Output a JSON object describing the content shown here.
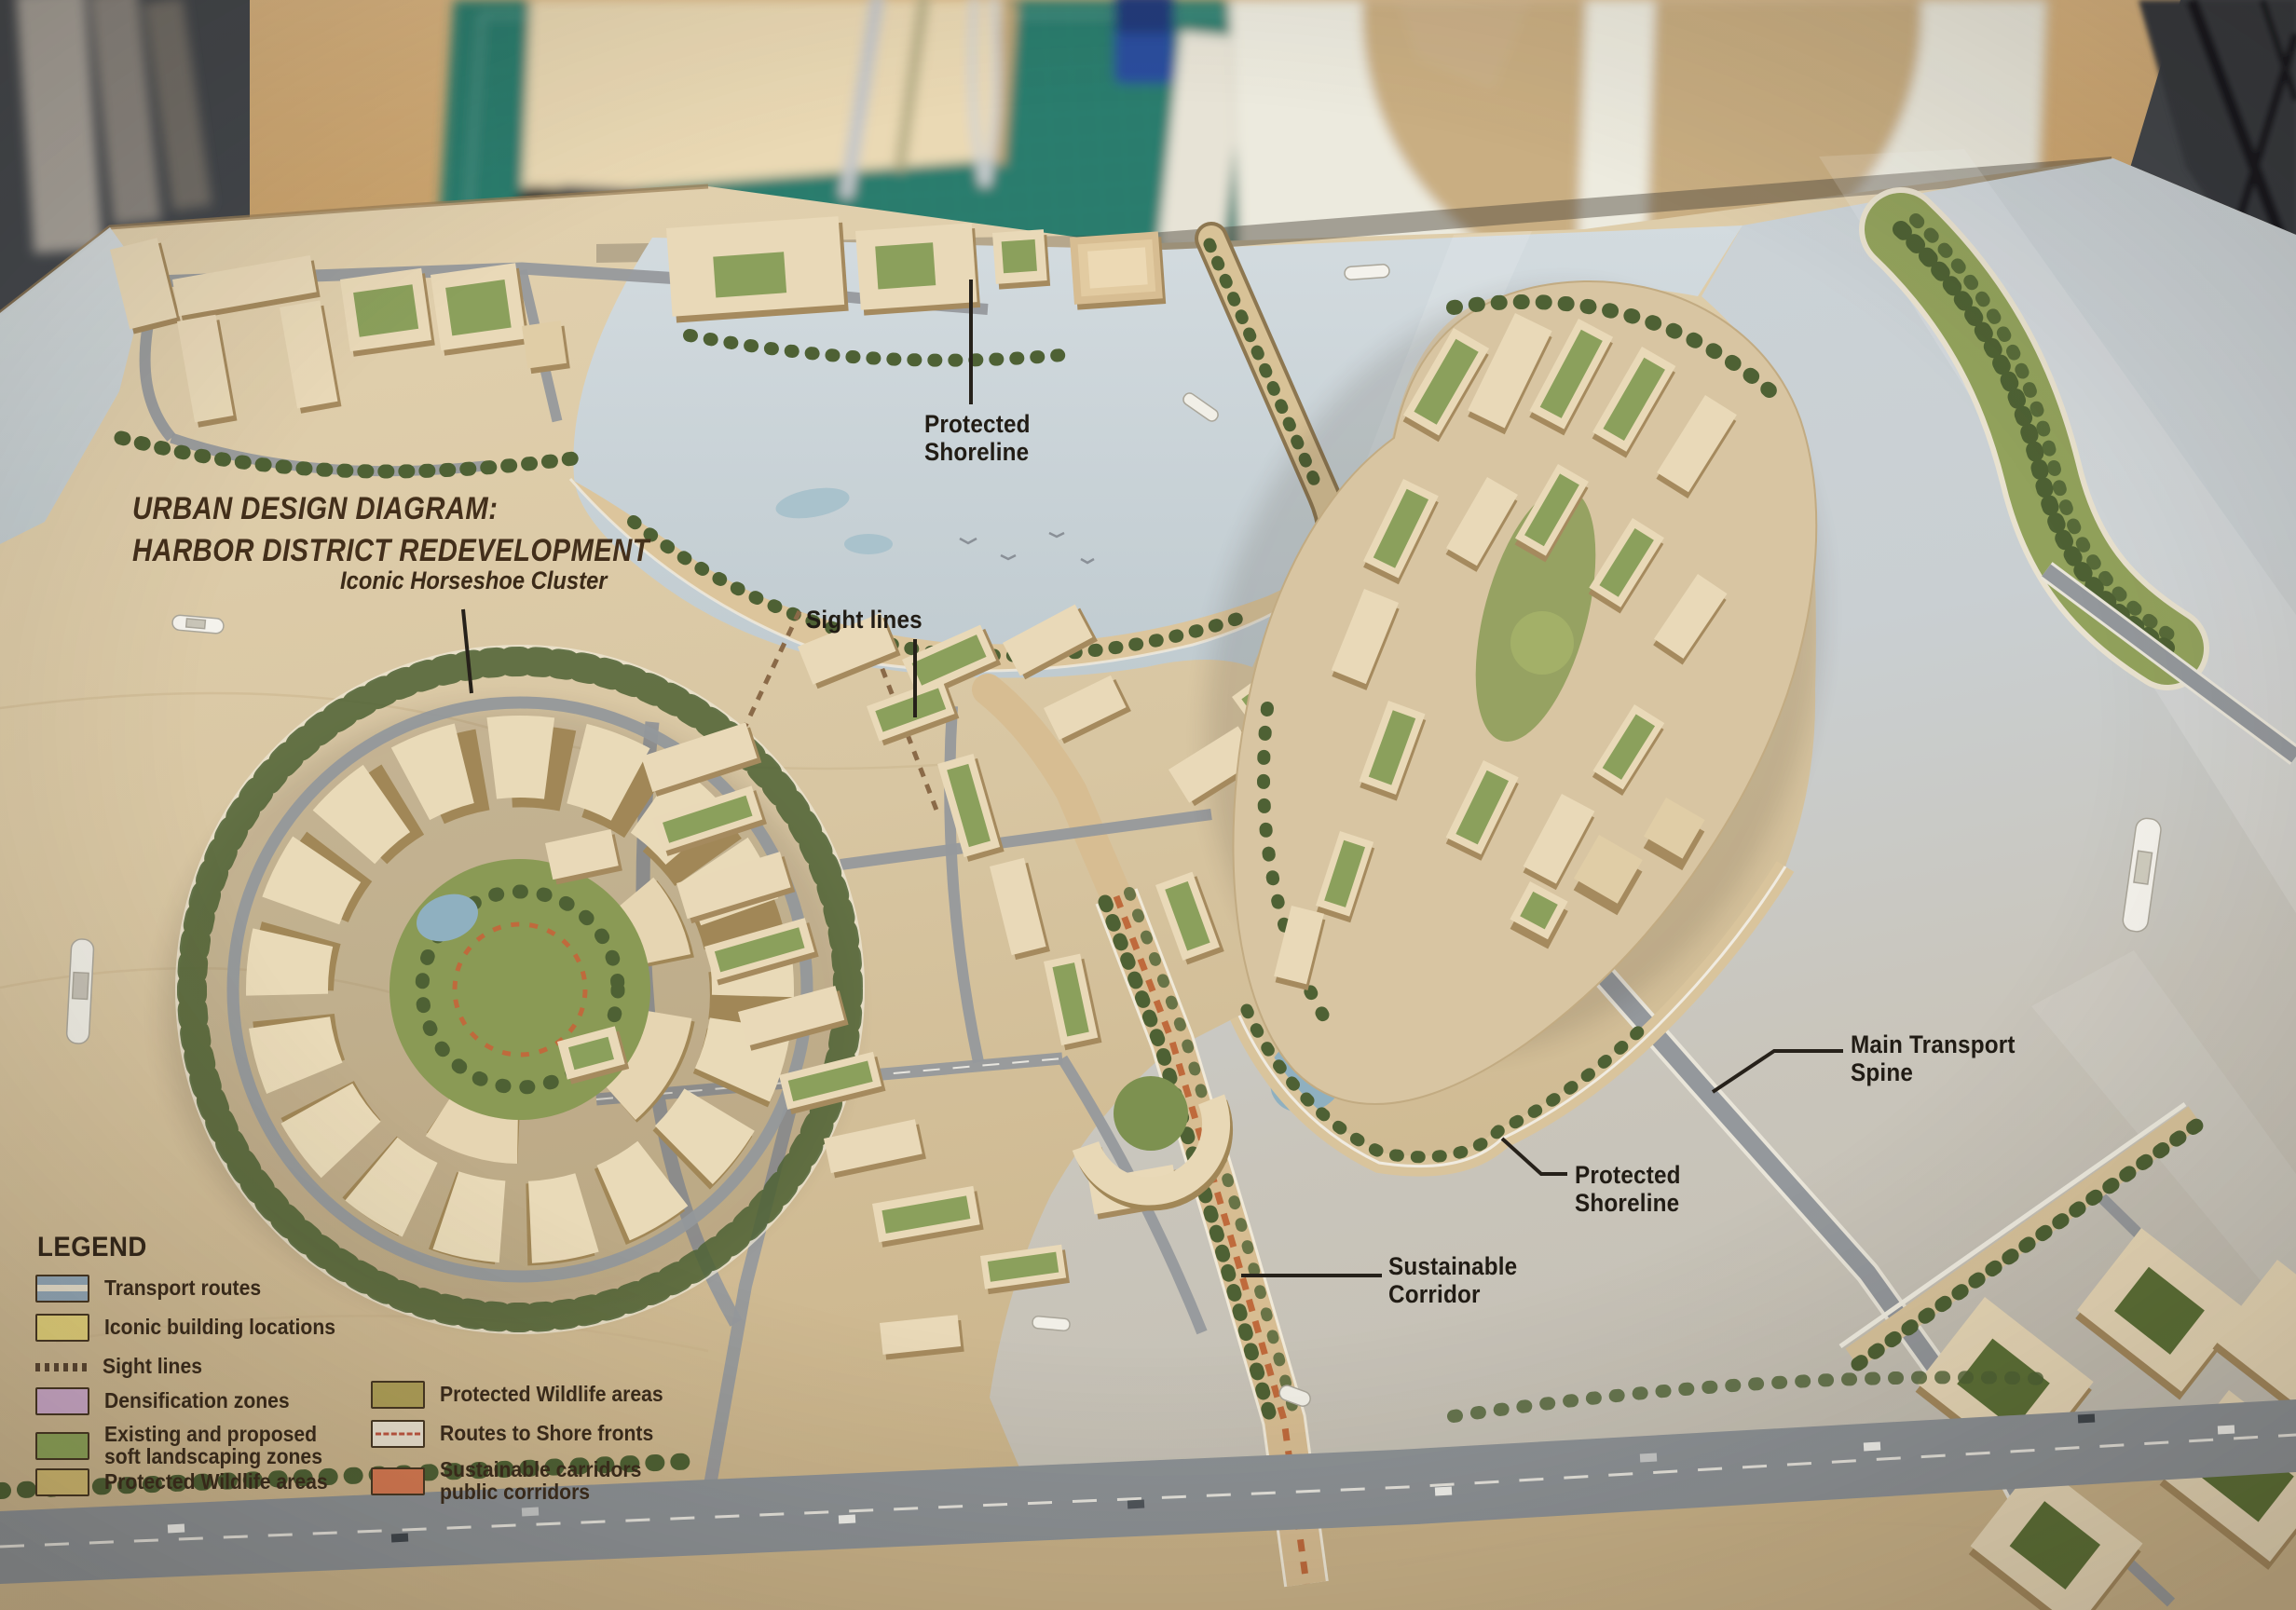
{
  "title": {
    "line1": "URBAN DESIGN DIAGRAM:",
    "line2": "HARBOR DISTRICT REDEVELOPMENT"
  },
  "annotations": {
    "iconic_horseshoe": {
      "text": "Iconic Horseshoe Cluster"
    },
    "protected_shoreline_top": {
      "line1": "Protected",
      "line2": "Shoreline"
    },
    "sight_lines": {
      "text": "Sight lines"
    },
    "main_transport_spine": {
      "line1": "Main Transport",
      "line2": "Spine"
    },
    "protected_shoreline_right": {
      "line1": "Protected",
      "line2": "Shoreline"
    },
    "sustainable_corridor": {
      "line1": "Sustainable",
      "line2": "Corridor"
    }
  },
  "legend": {
    "heading": "LEGEND",
    "left": [
      {
        "label": "Transport routes",
        "type": "transport",
        "colors": [
          "#93a9b9",
          "#e9e2ce"
        ]
      },
      {
        "label": "Iconic building locations",
        "type": "solid",
        "color": "#e6d47c"
      },
      {
        "label": "Sight lines",
        "type": "dashes",
        "color": "#5a4632"
      },
      {
        "label": "Densification zones",
        "type": "solid",
        "color": "#cfaccd"
      },
      {
        "label": "Existing and proposed",
        "label2": "soft landscaping zones",
        "type": "solid",
        "color": "#8fa65a"
      },
      {
        "label": "Protected Wildlife areas",
        "type": "solid",
        "color": "#d3bc72"
      }
    ],
    "right": [
      {
        "label": "Protected Wildlife areas",
        "type": "solid",
        "color": "#b0a058"
      },
      {
        "label": "Routes to Shore fronts",
        "type": "routes",
        "color": "#c05540"
      },
      {
        "label": "Sustainable carridors",
        "label2": "public corridors",
        "type": "solid",
        "color": "#d87a52"
      }
    ]
  },
  "palette": {
    "board_wood": "#d8c6a4",
    "harbor_water": "#ccd4d9",
    "lower_water": "#c6c1b5",
    "building_top": "#e9d9b8",
    "building_side": "#a58a5e",
    "green_roof": "#8ba05c",
    "tree_green": "#4e6134",
    "road_gray": "#96999c",
    "corridor_orange": "#bf6a3c",
    "sand": "#dcc59c",
    "cutting_mat": "#2b7b6d",
    "label_ink": "#211c15"
  }
}
